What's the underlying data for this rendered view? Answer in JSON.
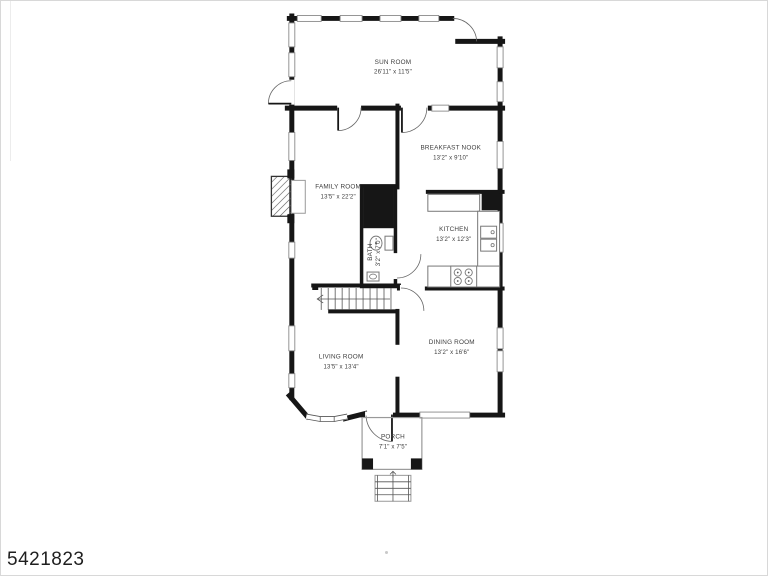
{
  "image_id": "5421823",
  "colors": {
    "wall": "#161616",
    "window_outline": "#8a8a8a",
    "label_text": "#3d3d3d",
    "background": "#ffffff"
  },
  "rooms": [
    {
      "name": "SUN ROOM",
      "dims": "26'11\" x 11'5\""
    },
    {
      "name": "BREAKFAST NOOK",
      "dims": "13'2\" x 9'10\""
    },
    {
      "name": "FAMILY ROOM",
      "dims": "13'5\" x 22'2\""
    },
    {
      "name": "KITCHEN",
      "dims": "13'2\" x 12'3\""
    },
    {
      "name": "BATH",
      "dims": "3'2\" x 7'0\""
    },
    {
      "name": "LIVING ROOM",
      "dims": "13'5\" x 13'4\""
    },
    {
      "name": "DINING ROOM",
      "dims": "13'2\" x 16'6\""
    },
    {
      "name": "PORCH",
      "dims": "7'1\" x 7'5\""
    }
  ]
}
